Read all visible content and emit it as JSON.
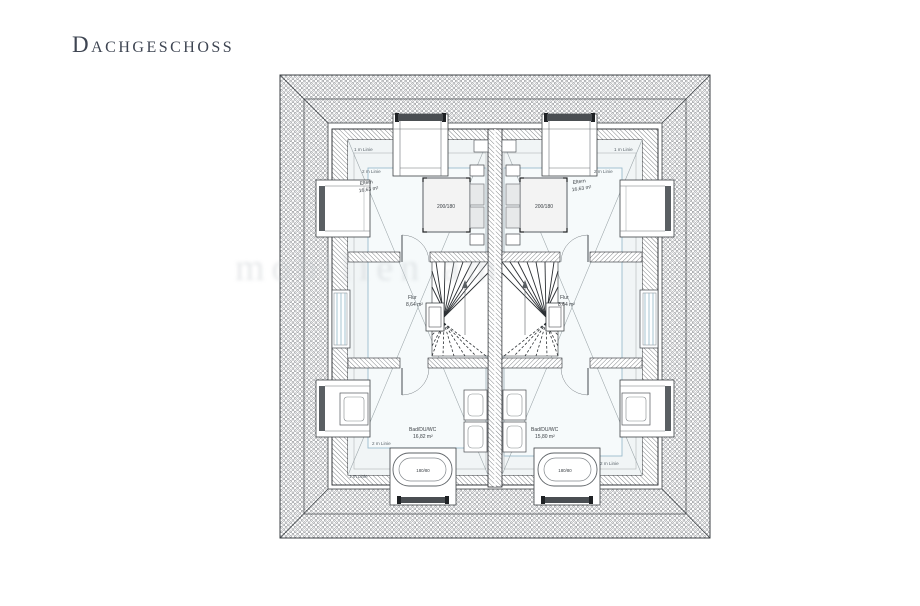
{
  "title": "Dachgeschoss",
  "watermark": "mobilien am",
  "labels": {
    "one_m": "1 m Linie",
    "two_m": "2 m Linie"
  },
  "plan": {
    "left": {
      "room": "Eltern",
      "room_area": "16,63 m²",
      "bed": "200/180",
      "hall": "Flur",
      "hall_area": "8,64 m²",
      "bath": "Bad/DU/WC",
      "bath_area": "16,82 m²",
      "tub": "180/80"
    },
    "right": {
      "room": "Eltern",
      "room_area": "16,63 m²",
      "bed": "200/180",
      "hall": "Flur",
      "hall_area": "8,64 m²",
      "bath": "Bad/DU/WC",
      "bath_area": "15,80 m²",
      "tub": "180/80"
    }
  }
}
